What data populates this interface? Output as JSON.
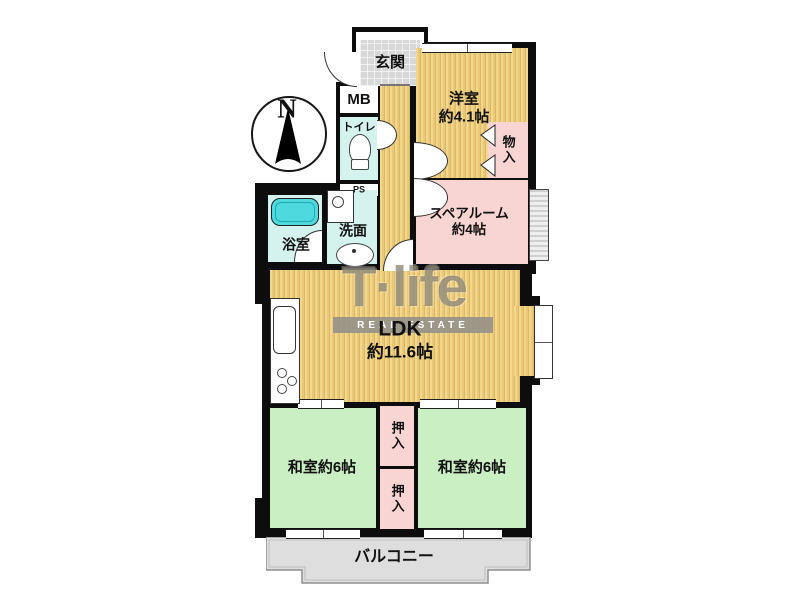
{
  "plan": {
    "compass_label": "N",
    "watermark": {
      "brand": "T·life",
      "subtitle": "REAL ESTATE"
    },
    "rooms": {
      "genkan": "玄関",
      "mb": "MB",
      "toilet": "トイレ",
      "ps": "PS",
      "bath": "浴室",
      "wash": "洗面",
      "western": {
        "name": "洋室",
        "size": "約4.1帖"
      },
      "storage": "物入",
      "spare": {
        "name": "スペアルーム",
        "size": "約4帖"
      },
      "ldk": {
        "name": "LDK",
        "size": "約11.6帖"
      },
      "closet_upper": "押入",
      "closet_lower": "押入",
      "japanese_left": "和室約6帖",
      "japanese_right": "和室約6帖",
      "balcony": "バルコニー"
    },
    "colors": {
      "wall": "#0d0d0d",
      "wood_floor": "#ecca7d",
      "tatami_green": "#c9efc3",
      "closet_pink": "#f8d5d2",
      "wet_area_cyan": "#d4f3ef",
      "bathtub": "#4ed9de",
      "balcony_gray": "#dedede",
      "entrance_tile": "#d8d8d8"
    }
  }
}
